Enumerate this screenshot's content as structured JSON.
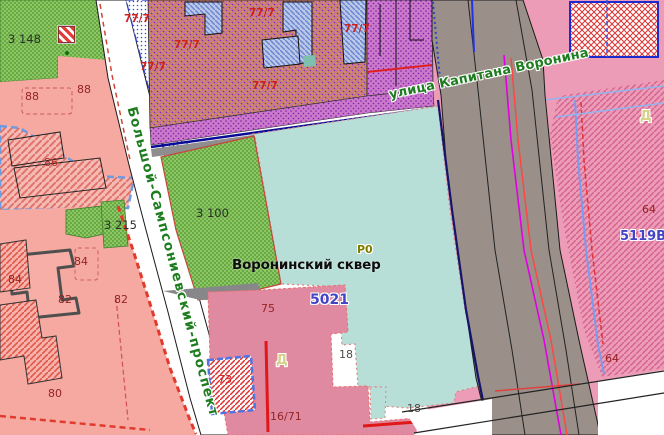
{
  "map_title": "Cadastral map fragment — Воронинский сквер",
  "streets": {
    "voronina": "улица Капитана Воронина",
    "sampsonievsky": "Большой-Сампсониевский-проспект"
  },
  "park": {
    "name": "Воронинский сквер",
    "zone_code": "Р0"
  },
  "labels": [
    {
      "name": "street-voronina",
      "text": "улица Капитана Воронина"
    },
    {
      "name": "street-sampsonievsky",
      "text": "Большой-Сампсониевский-проспект"
    },
    {
      "name": "park-name",
      "text": "Воронинский сквер"
    },
    {
      "name": "zone-r0",
      "text": "Р0"
    },
    {
      "name": "lot-5021",
      "text": "5021"
    },
    {
      "name": "lot-5119v",
      "text": "5119В"
    },
    {
      "name": "zone-d-right",
      "text": "Д"
    },
    {
      "name": "zone-d-center",
      "text": "Д"
    },
    {
      "name": "parcel-3148",
      "text": "3 148"
    },
    {
      "name": "parcel-3100",
      "text": "3 100"
    },
    {
      "name": "parcel-3215",
      "text": "3 215"
    },
    {
      "name": "house-88-a",
      "text": "88"
    },
    {
      "name": "house-88-b",
      "text": "88"
    },
    {
      "name": "house-86",
      "text": "86"
    },
    {
      "name": "house-84-a",
      "text": "84"
    },
    {
      "name": "house-84-b",
      "text": "84"
    },
    {
      "name": "house-82-a",
      "text": "82"
    },
    {
      "name": "house-82-b",
      "text": "82"
    },
    {
      "name": "house-80",
      "text": "80"
    },
    {
      "name": "house-75",
      "text": "75"
    },
    {
      "name": "house-73",
      "text": "73"
    },
    {
      "name": "house-64-a",
      "text": "64"
    },
    {
      "name": "house-64-b",
      "text": "64"
    },
    {
      "name": "house-18-a",
      "text": "18"
    },
    {
      "name": "house-18-b",
      "text": "18"
    },
    {
      "name": "house-16-71",
      "text": "16/71"
    },
    {
      "name": "lot-777-1",
      "text": "77/7"
    },
    {
      "name": "lot-777-2",
      "text": "77/7"
    },
    {
      "name": "lot-777-3",
      "text": "77/7"
    },
    {
      "name": "lot-777-4",
      "text": "77/7"
    },
    {
      "name": "lot-777-5",
      "text": "77/7"
    },
    {
      "name": "lot-777-6",
      "text": "77/7"
    }
  ],
  "colors": {
    "park_green": "#8cc763",
    "teal_square": "#b7ded7",
    "road_gray": "#9a9089",
    "salmon_block": "#f5a9a1",
    "rose_parcel": "#e08aa2",
    "right_pink": "#ec9cb6",
    "orange_zone": "#d28e5e",
    "magenta_strip": "#cb79cb",
    "street_label_green": "#1e7d1e",
    "label_blue": "#4343c8",
    "label_red": "#cf2020",
    "label_olive": "#7d7d00",
    "label_khaki": "#d6d28a",
    "border_navy": "#0a0a96",
    "border_blue_dash": "#4f74e3"
  }
}
